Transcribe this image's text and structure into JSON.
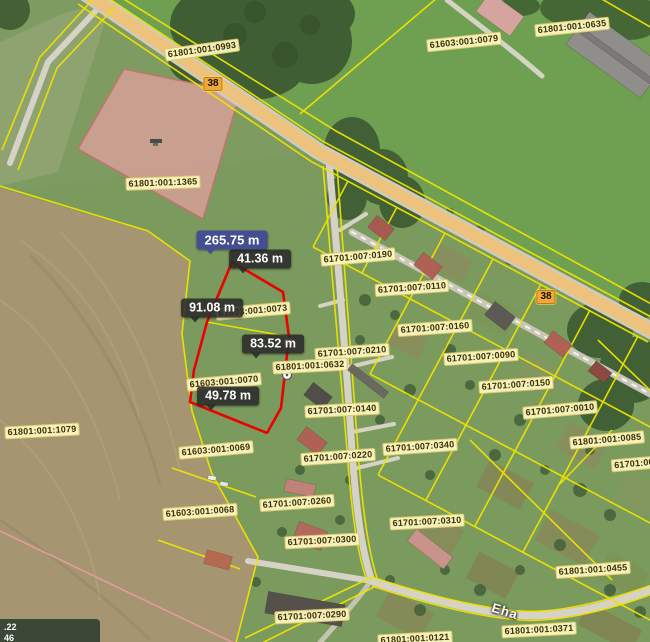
{
  "map": {
    "parcel_labels": [
      {
        "text": "61801:001:0993",
        "x": 202,
        "y": 50,
        "rot": -8
      },
      {
        "text": "61603:001:0079",
        "x": 464,
        "y": 42,
        "rot": -6
      },
      {
        "text": "61801:001:0635",
        "x": 572,
        "y": 27,
        "rot": -6
      },
      {
        "text": "61801:001:1365",
        "x": 163,
        "y": 183,
        "rot": -2
      },
      {
        "text": "61701:007:0190",
        "x": 358,
        "y": 257,
        "rot": -5
      },
      {
        "text": "61701:007:0110",
        "x": 412,
        "y": 288,
        "rot": -4
      },
      {
        "text": "61603:001:0073",
        "x": 253,
        "y": 311,
        "rot": -5
      },
      {
        "text": "61701:007:0160",
        "x": 435,
        "y": 328,
        "rot": -4
      },
      {
        "text": "61701:007:0210",
        "x": 352,
        "y": 352,
        "rot": -4
      },
      {
        "text": "61701:007:0090",
        "x": 481,
        "y": 357,
        "rot": -4
      },
      {
        "text": "61801:001:0632",
        "x": 310,
        "y": 366,
        "rot": -3
      },
      {
        "text": "61603:001:0070",
        "x": 224,
        "y": 382,
        "rot": -5
      },
      {
        "text": "61701:007:0150",
        "x": 516,
        "y": 385,
        "rot": -4
      },
      {
        "text": "61701:007:0140",
        "x": 342,
        "y": 410,
        "rot": -3
      },
      {
        "text": "61701:007:0010",
        "x": 560,
        "y": 410,
        "rot": -5
      },
      {
        "text": "61801:001:1079",
        "x": 42,
        "y": 431,
        "rot": -3
      },
      {
        "text": "61801:001:0085",
        "x": 607,
        "y": 440,
        "rot": -5
      },
      {
        "text": "61701:007:0340",
        "x": 420,
        "y": 447,
        "rot": -4
      },
      {
        "text": "61603:001:0069",
        "x": 216,
        "y": 450,
        "rot": -5
      },
      {
        "text": "61701:007:0220",
        "x": 338,
        "y": 457,
        "rot": -4
      },
      {
        "text": "61701:00",
        "x": 634,
        "y": 464,
        "rot": -5
      },
      {
        "text": "61701:007:0260",
        "x": 297,
        "y": 503,
        "rot": -4
      },
      {
        "text": "61603:001:0068",
        "x": 200,
        "y": 512,
        "rot": -4
      },
      {
        "text": "61701:007:0310",
        "x": 427,
        "y": 522,
        "rot": -3
      },
      {
        "text": "61701:007:0300",
        "x": 322,
        "y": 541,
        "rot": -3
      },
      {
        "text": "61801:001:0455",
        "x": 593,
        "y": 570,
        "rot": -4
      },
      {
        "text": "61701:007:0290",
        "x": 312,
        "y": 616,
        "rot": -3
      },
      {
        "text": "61801:001:0371",
        "x": 539,
        "y": 630,
        "rot": -3
      },
      {
        "text": "61801:001:0121",
        "x": 415,
        "y": 639,
        "rot": -3
      }
    ],
    "road_badges": [
      {
        "text": "38",
        "x": 213,
        "y": 84
      },
      {
        "text": "38",
        "x": 546,
        "y": 297
      }
    ],
    "street_labels": [
      {
        "text": "Eha",
        "x": 505,
        "y": 611,
        "rot": 17
      }
    ],
    "measurements": {
      "total": {
        "text": "265.75 m",
        "x": 232,
        "y": 240
      },
      "segments": [
        {
          "text": "41.36 m",
          "x": 260,
          "y": 259
        },
        {
          "text": "91.08 m",
          "x": 212,
          "y": 308
        },
        {
          "text": "83.52 m",
          "x": 273,
          "y": 344
        },
        {
          "text": "49.78 m",
          "x": 228,
          "y": 396
        }
      ]
    },
    "info_box": {
      "line1": ".22",
      "line2": "46"
    },
    "colors": {
      "boundary": "#f0e300",
      "selection": "#e80202",
      "road_fill": "#ecc27c",
      "label_bg": "#fdf7c4",
      "tooltip_bg": "#2a2a2a",
      "tooltip_primary_bg": "#454e91"
    }
  }
}
